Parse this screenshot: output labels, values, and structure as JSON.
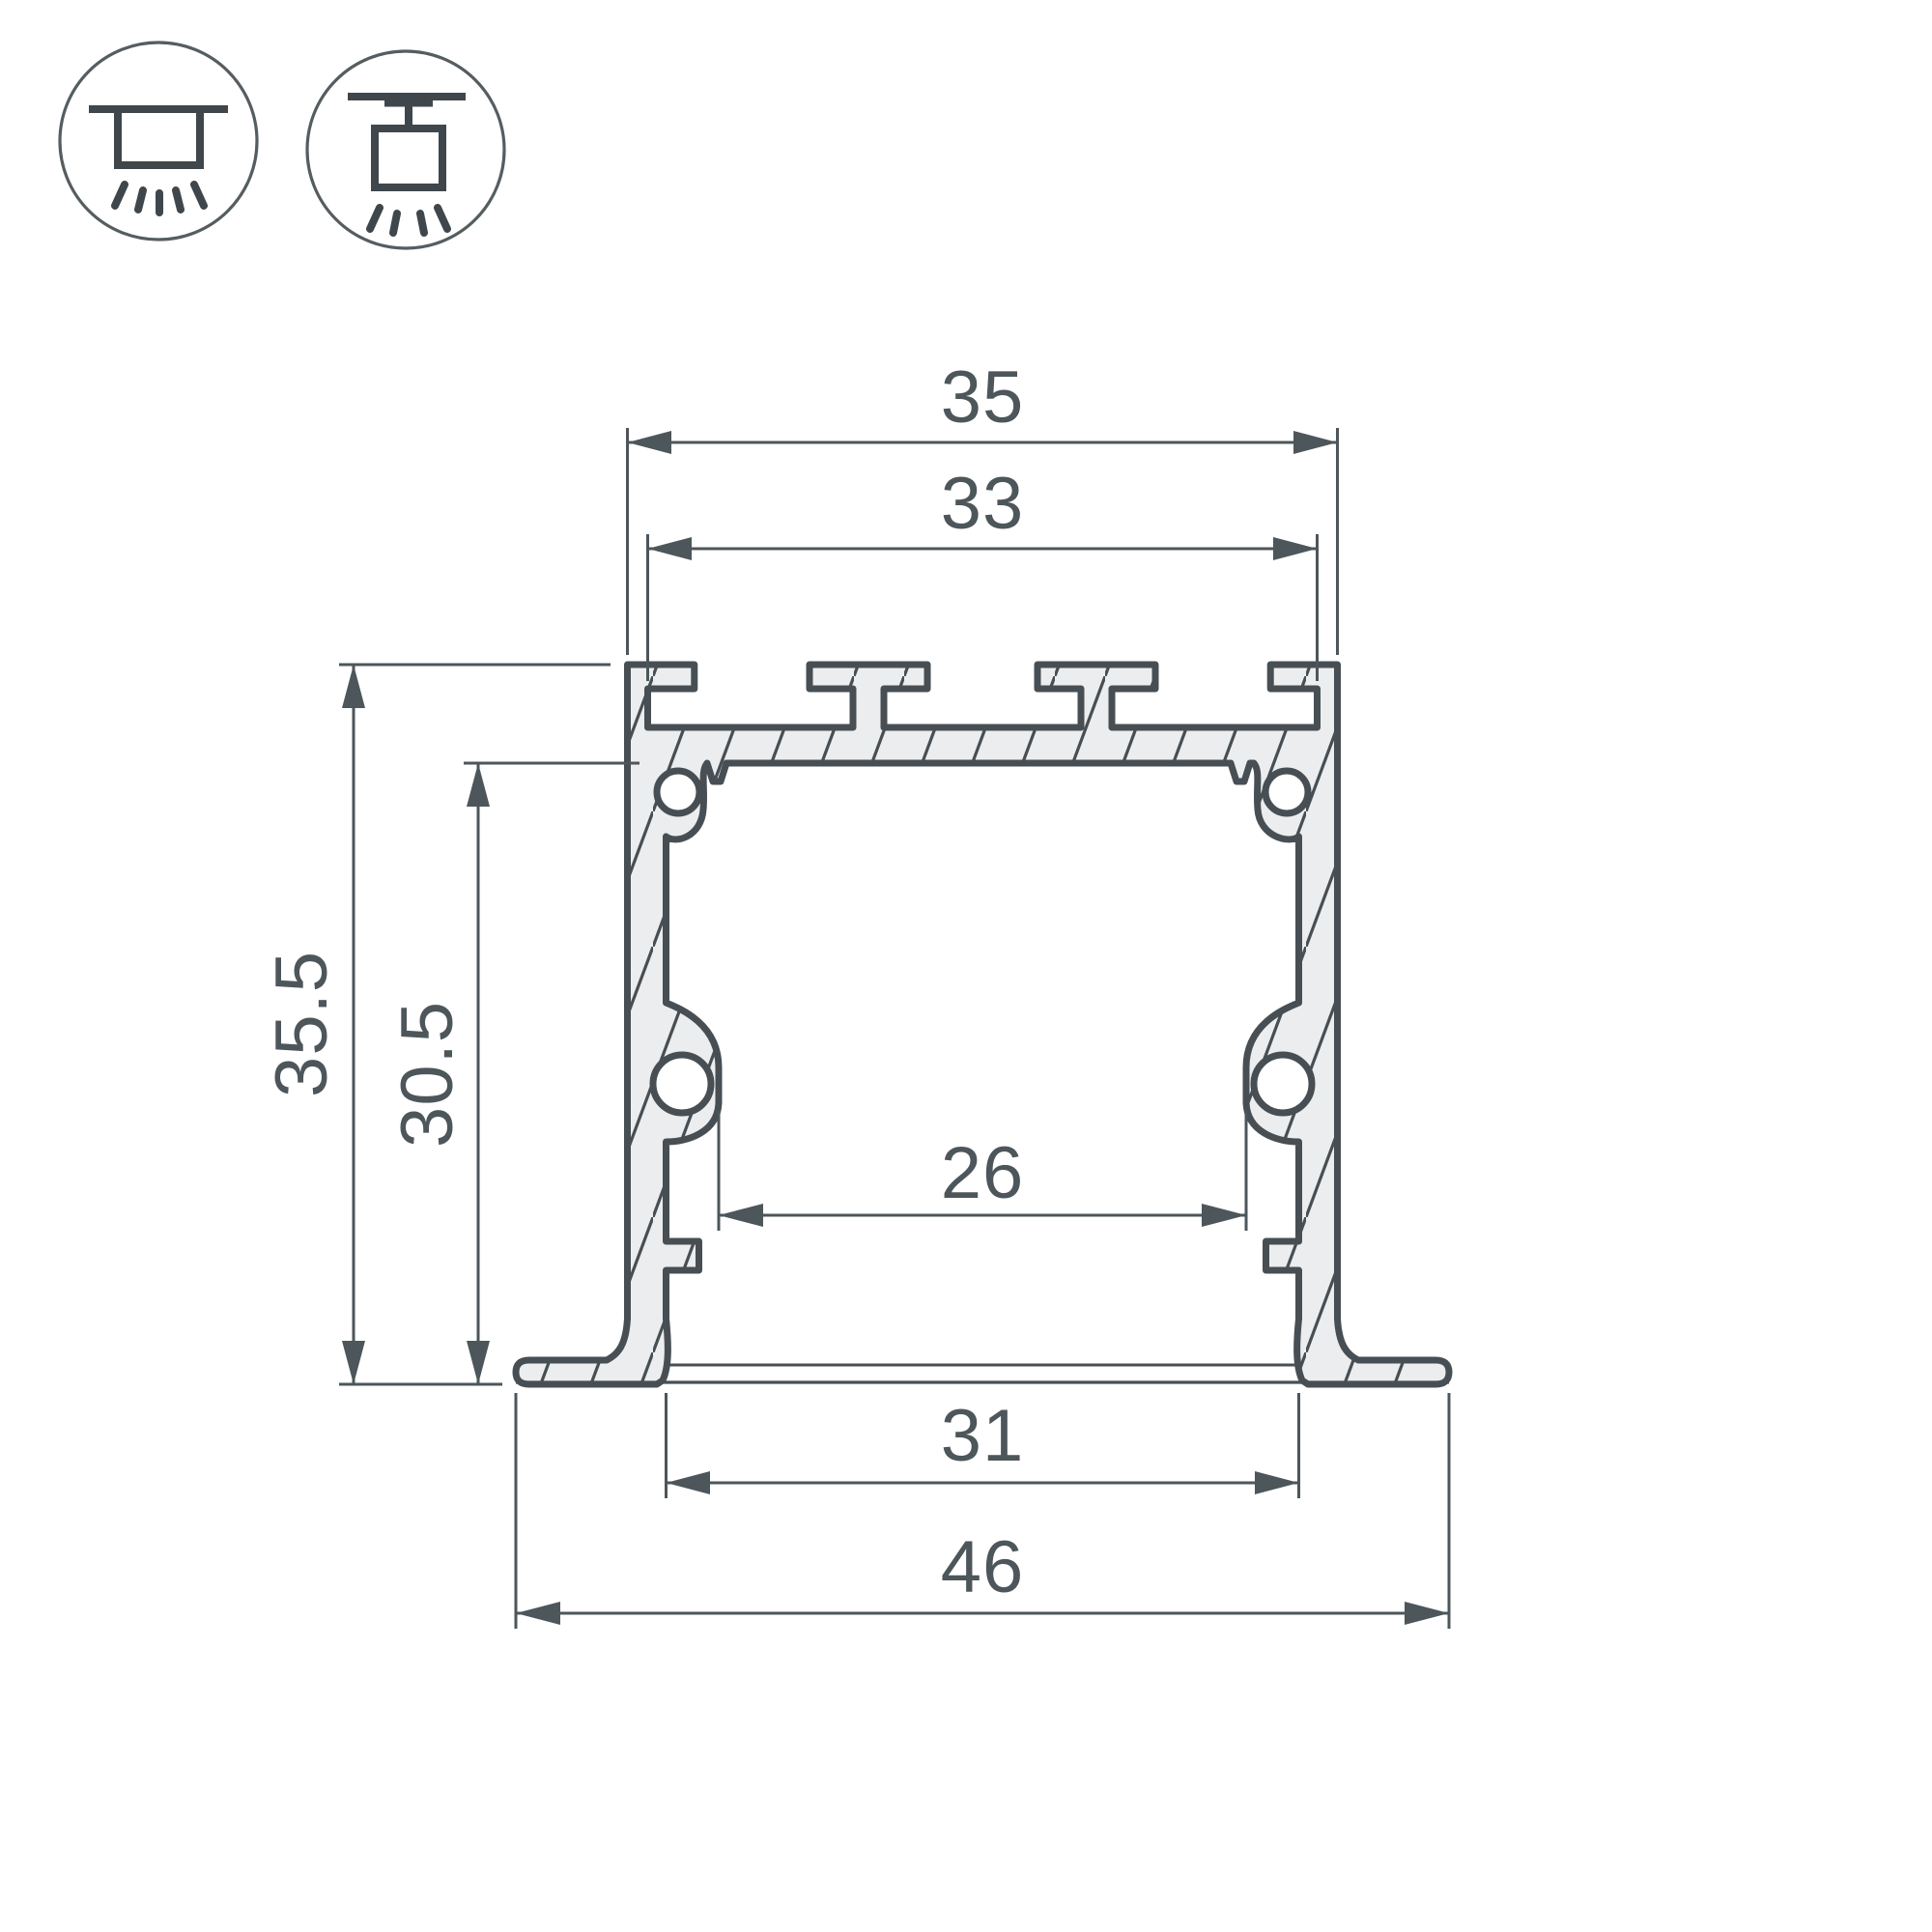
{
  "drawing": {
    "type": "profile-cross-section",
    "units_implied": "mm"
  },
  "colors": {
    "background": "#ffffff",
    "outline": "#474f54",
    "metal_fill": "#ecedee",
    "dimension_lines": "#4d565a",
    "text": "#4d565a"
  },
  "icons": [
    {
      "name": "recessed-mount-icon"
    },
    {
      "name": "surface-mount-icon"
    }
  ],
  "dimensions": {
    "top_outer_width": "35",
    "top_inner_width": "33",
    "overall_height": "35.5",
    "inner_height": "30.5",
    "inner_width": "26",
    "bottom_opening_width": "31",
    "overall_width": "46"
  }
}
